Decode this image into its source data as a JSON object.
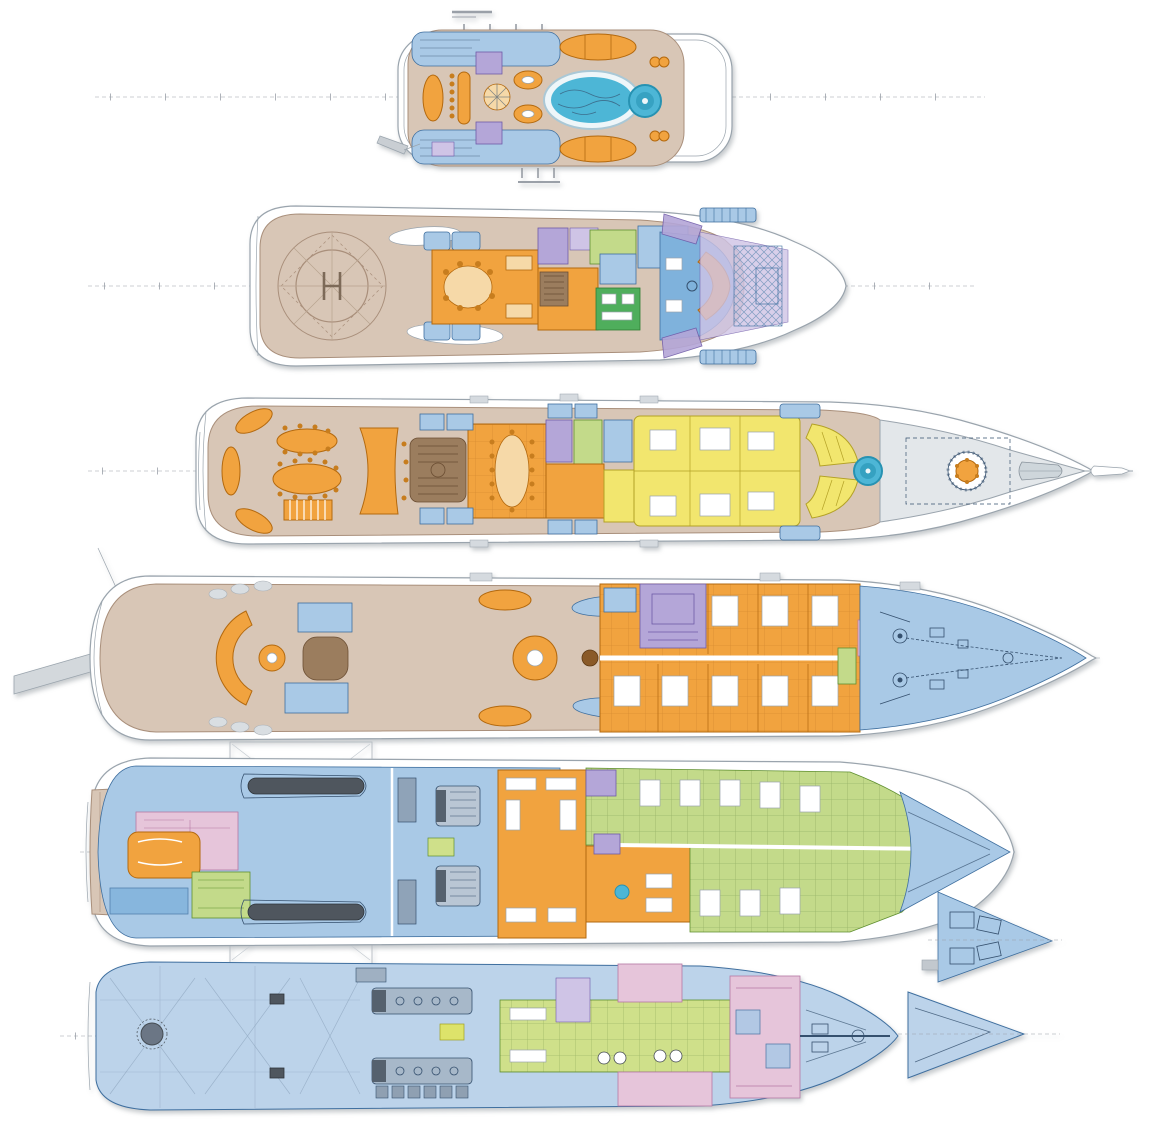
{
  "figure": {
    "deck_count": 6,
    "orientation": "bow-right"
  },
  "palette": {
    "deck_teak": "#d8c6b6",
    "teak_line": "#a98f7b",
    "guest_orange": "#f1a33f",
    "orange_line": "#b3690f",
    "owner_yellow": "#f2e66e",
    "yellow_line": "#b3a126",
    "pool_water": "#4db6d6",
    "pool_deep": "#2792b2",
    "service_blue": "#a9c9e6",
    "blue_line": "#3f6f9f",
    "bright_blue": "#7fb2dc",
    "hull_pale_blue": "#bcd3ea",
    "crew_green": "#c3da8a",
    "green_line": "#5f8f2f",
    "wellness_green": "#4fae5c",
    "media_purple": "#b4a6d8",
    "purple_line": "#6f5aa8",
    "overhang_lavender": "#cfc4e6",
    "beach_pink": "#e6c5da",
    "pink_line": "#b679a4",
    "foredeck_gray": "#e3e7ea",
    "hull_line": "#9aa4ad",
    "tender_dark": "#4f565e",
    "stair_brown": "#9b7d5e",
    "drawing_ink": "#35506e",
    "background": "#ffffff"
  },
  "decks": [
    {
      "name": "sun-deck",
      "features": [
        "mast-marks",
        "side-stairs",
        "lounge-oval",
        "bar-counter",
        "bar-stools",
        "compass-table",
        "curved-sofas",
        "sun-pads",
        "swimming-pool",
        "jacuzzi",
        "pantograph-davit"
      ]
    },
    {
      "name": "bridge-deck",
      "features": [
        "helipad",
        "touchdown-circle",
        "stair-openings",
        "al-fresco-seating",
        "sky-lounge",
        "dining-table",
        "pantry-stair",
        "cabins",
        "wheelhouse",
        "helm-console",
        "foredeck-working-area",
        "side-boarding-platforms"
      ]
    },
    {
      "name": "owner-deck",
      "features": [
        "aft-corner-sofas",
        "oval-dining-tables",
        "awning",
        "bar",
        "main-staircase",
        "salon",
        "salon-table",
        "day-rooms",
        "owner-suite",
        "owner-sun-pads",
        "spa-pool",
        "crane-turntable",
        "tender",
        "bowsprit"
      ]
    },
    {
      "name": "main-deck",
      "features": [
        "passerelle",
        "stern-loungers",
        "arc-sofa",
        "coffee-table",
        "lobby",
        "day-heads",
        "al-fresco-table",
        "sun-pads",
        "main-salon",
        "fireplace",
        "cinema-room",
        "guest-cabins",
        "stair-wedge",
        "pink-room",
        "anchor-windlass",
        "mooring-gear"
      ]
    },
    {
      "name": "lower-deck",
      "features": [
        "swim-platform",
        "beach-club",
        "bar-lounge",
        "sauna",
        "store-rooms",
        "tender-garage",
        "tenders",
        "garage-hatch",
        "switchboards",
        "engine-room",
        "engines",
        "galley",
        "cold-rooms",
        "crew-mess",
        "crew-cabins",
        "chain-locker",
        "bow-inset"
      ]
    },
    {
      "name": "tank-deck",
      "features": [
        "stern-thruster",
        "mooring-bitts",
        "tank-bracing",
        "main-engines",
        "generator",
        "equipment-row",
        "laundry",
        "washing-machines",
        "cold-stores",
        "stabilizer-rooms",
        "shaft-alley",
        "forepeak-inset"
      ]
    }
  ]
}
